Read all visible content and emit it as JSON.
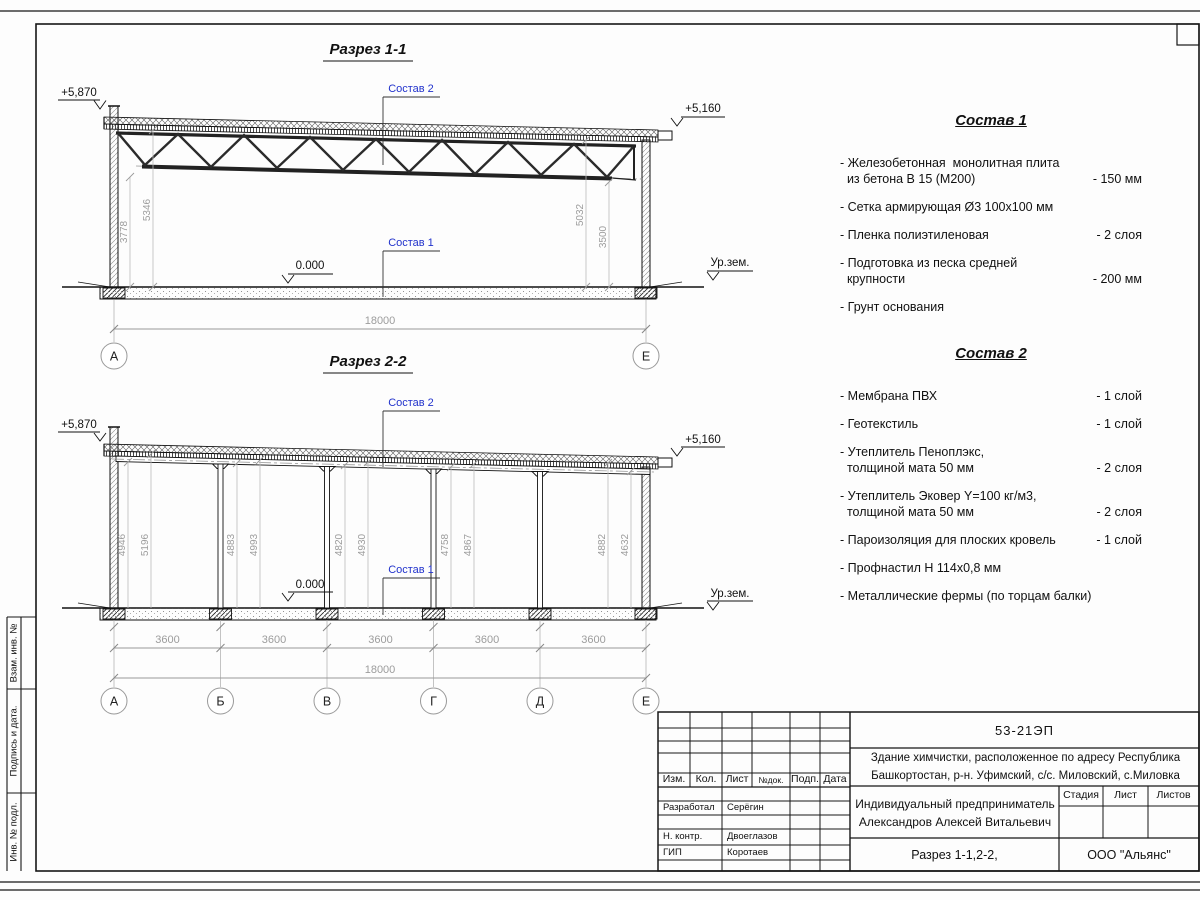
{
  "section1": {
    "title": "Разрез 1-1",
    "elev_left": "+5,870",
    "elev_right": "+5,160",
    "elev_zero": "0.000",
    "ground": "Ур.зем.",
    "callout_top": "Состав 2",
    "callout_bottom": "Состав 1",
    "dims_vertical": [
      "3778",
      "5346",
      "5032",
      "3500"
    ],
    "dim_total": "18000",
    "axes": [
      "А",
      "Е"
    ]
  },
  "section2": {
    "title": "Разрез 2-2",
    "elev_left": "+5,870",
    "elev_right": "+5,160",
    "elev_zero": "0.000",
    "ground": "Ур.зем.",
    "callout_top": "Состав 2",
    "callout_bottom": "Состав 1",
    "dims_vertical": [
      "4946",
      "5196",
      "4883",
      "4993",
      "4820",
      "4930",
      "4758",
      "4867",
      "4882",
      "4632"
    ],
    "dims_span": [
      "3600",
      "3600",
      "3600",
      "3600",
      "3600"
    ],
    "dim_total": "18000",
    "axes": [
      "А",
      "Б",
      "В",
      "Г",
      "Д",
      "Е"
    ]
  },
  "sostav1": {
    "title": "Состав 1",
    "items": [
      {
        "text": "- Железобетонная  монолитная плита\n  из бетона В 15 (М200)",
        "value": "- 150 мм"
      },
      {
        "text": "- Сетка армирующая Ø3 100х100 мм",
        "value": ""
      },
      {
        "text": "- Пленка полиэтиленовая",
        "value": "-  2 слоя"
      },
      {
        "text": "- Подготовка из песка средней\n  крупности",
        "value": "- 200 мм"
      },
      {
        "text": "- Грунт основания",
        "value": ""
      }
    ]
  },
  "sostav2": {
    "title": "Состав 2",
    "items": [
      {
        "text": "- Мембрана ПВХ",
        "value": "- 1 слой"
      },
      {
        "text": "- Геотекстиль",
        "value": "- 1 слой"
      },
      {
        "text": "- Утеплитель Пеноплэкс,\n  толщиной мата 50 мм",
        "value": "- 2 слоя"
      },
      {
        "text": "- Утеплитель Эковер Y=100 кг/м3,\n  толщиной мата 50 мм",
        "value": "- 2 слоя"
      },
      {
        "text": "- Пароизоляция для плоских кровель",
        "value": "- 1 слой"
      },
      {
        "text": "- Профнастил Н 114х0,8 мм",
        "value": ""
      },
      {
        "text": "- Металлические фермы (по торцам балки)",
        "value": ""
      }
    ]
  },
  "titleblock": {
    "doc_number": "53-21ЭП",
    "object": "Здание химчистки,  расположенное по адресу Республика\nБашкортостан, р-н. Уфимский, с/с. Миловский, с.Миловка",
    "client": "Индивидуальный предприниматель\nАлександров Алексей Витальевич",
    "sheet_title": "Разрез 1-1,2-2,",
    "company": "ООО \"Альянс\"",
    "columns": [
      "Изм.",
      "Кол.",
      "Лист",
      "№док.",
      "Подп.",
      "Дата"
    ],
    "stage_columns": [
      "Стадия",
      "Лист",
      "Листов"
    ],
    "roles": [
      {
        "role": "Разработал",
        "name": "Серёгин"
      },
      {
        "role": "Н. контр.",
        "name": "Двоеглазов"
      },
      {
        "role": "ГИП",
        "name": "Коротаев"
      }
    ]
  },
  "side_stamp": {
    "labels": [
      "Взам. инв. №",
      "Подпись  и  дата.",
      "Инв. № подл."
    ]
  }
}
